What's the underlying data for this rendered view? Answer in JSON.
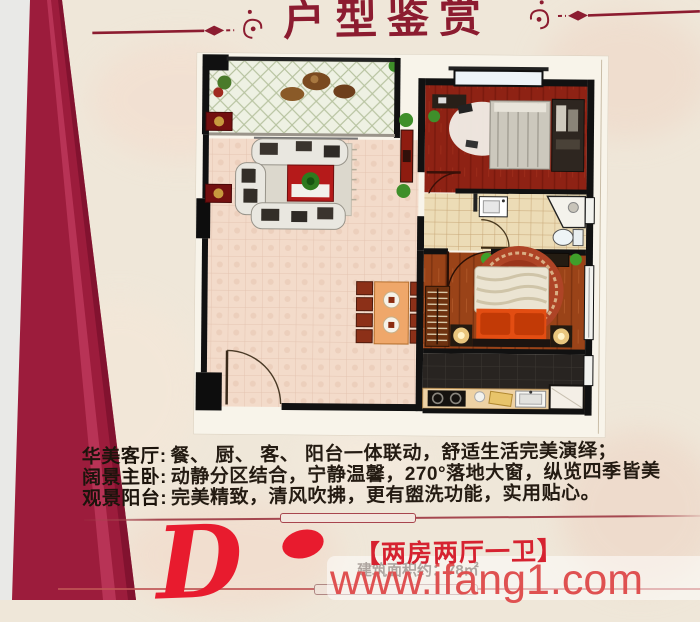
{
  "header": {
    "title": "户型鉴赏"
  },
  "description": {
    "lines": [
      {
        "label": "华美客厅:",
        "text": "餐、 厨、 客、 阳台一体联动，舒适生活完美演绎；"
      },
      {
        "label": "阔景主卧:",
        "text": "动静分区结合，宁静温馨，270°落地大窗，纵览四季皆美"
      },
      {
        "label": "观景阳台:",
        "text": "完美精致，清风吹拂，更有盥洗功能，实用贴心。"
      }
    ]
  },
  "footer": {
    "unit_letter": "D",
    "unit_type": "【两房两厅一卫】",
    "area_text": "建筑面积约：78㎡",
    "watermark": "www.ifang1.com"
  },
  "colors": {
    "title_red": "#8c1c30",
    "accent_red": "#e81b2e",
    "unit_type_red": "#d62230",
    "watermark_red": "#df5151",
    "crimson_band": "#9c1c3c",
    "marble_bg": "#efe7d9",
    "living_floor_pink": "#f3dbca",
    "bedroom_floor_red": "#8e2214",
    "master_floor_wood": "#9a4318"
  }
}
